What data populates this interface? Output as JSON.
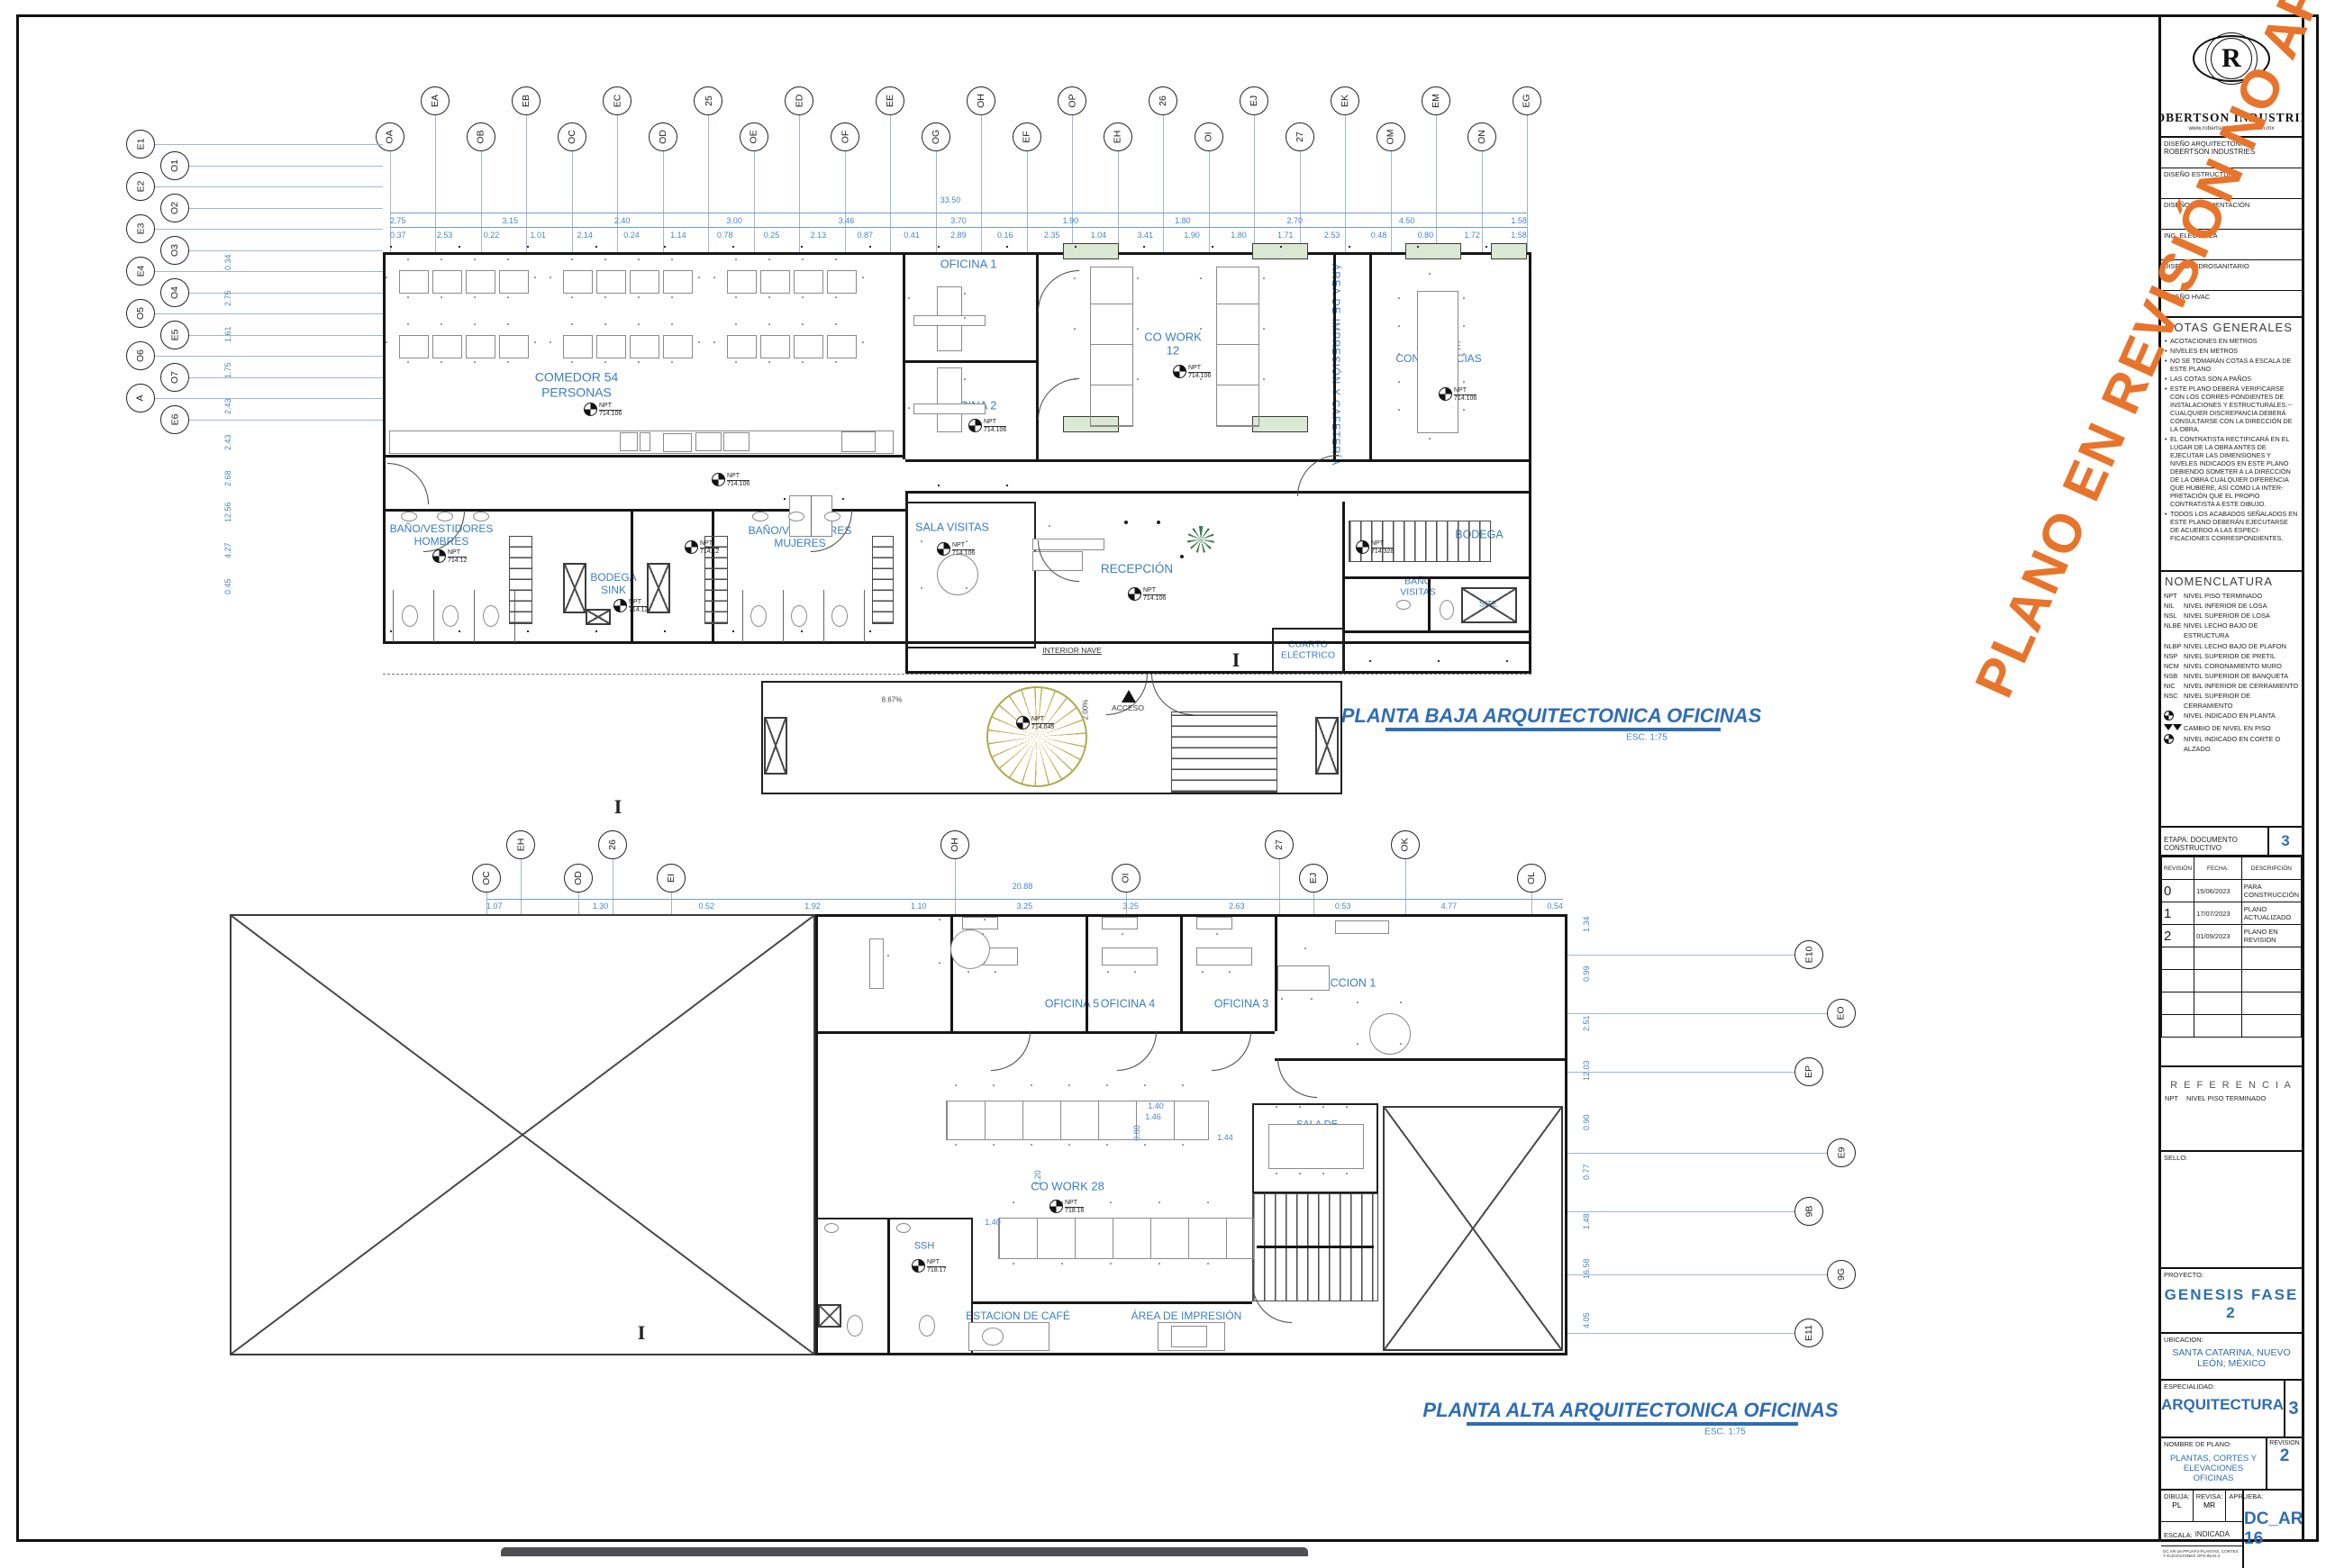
{
  "colors": {
    "accent_blue": "#2f6db5",
    "dim_blue": "#4a85c4",
    "watermark_orange": "#E8742B",
    "window_green": "#dbe8d3",
    "column_blue": "#49648f"
  },
  "watermark": "PLANO EN REVISIÓN NO APROBADO PARA CONSTRUCCIÓN",
  "title_block": {
    "logo_letter": "R",
    "company": "ROBERTSON  INDUSTRIES",
    "website": "www.robertsonindustries.com.mx",
    "design_rows": [
      {
        "label": "DISEÑO  ARQUITECTONICO",
        "value": "ROBERTSON INDUSTRIES"
      },
      {
        "label": "DISEÑO  ESTRUCTURAL",
        "value": ""
      },
      {
        "label": "DISEÑO  DE  CIMENTACIÓN",
        "value": ""
      },
      {
        "label": "ING.  ELÉCTRICA",
        "value": ""
      },
      {
        "label": "DISEÑO  HIDROSANITARIO",
        "value": ""
      },
      {
        "label": "DISEÑO  HVAC",
        "value": ""
      }
    ],
    "notas": {
      "title": "NOTAS GENERALES",
      "items": [
        "ACOTACIONES EN METROS",
        "NIVELES EN METROS",
        "NO SE TOMARÁN COTAS A ESCALA DE ESTE PLANO",
        "LAS COTAS SON A PAÑOS",
        "ESTE PLANO DEBERÁ VERIFICARSE CON LOS CORRES-PONDIENTES DE INSTALACIONES Y ESTRUCTURALES.--CUALQUIER DISCREPANCIA DEBERÁ CONSULTARSE CON LA DIRECCIÓN DE LA OBRA.",
        "EL CONTRATISTA RECTIFICARÁ EN EL LUGAR DE LA OBRA ANTES DE EJECUTAR LAS DIMENSIONES Y NIVELES INDICADOS EN ESTE PLANO DEBIENDO SOMETER A LA DIRECCIÓN DE LA OBRA CUALQUIER DIFERENCIA QUE HUBIERE, ASÍ COMO LA INTER-PRETACIÓN QUE EL PROPIO CONTRATISTA A ESTE DIBUJO.",
        "TODOS LOS ACABADOS SEÑALADOS EN ESTE PLANO DEBERÁN EJECUTARSE DE ACUERDO A LAS ESPECI-FICACIONES CORRESPONDIENTES."
      ]
    },
    "nomenclatura": {
      "title": "NOMENCLATURA",
      "items": [
        {
          "abbr": "NPT",
          "text": "NIVEL PISO TERMINADO",
          "icon": ""
        },
        {
          "abbr": "NIL",
          "text": "NIVEL INFERIOR DE LOSA",
          "icon": ""
        },
        {
          "abbr": "NSL",
          "text": "NIVEL SUPERIOR DE LOSA",
          "icon": ""
        },
        {
          "abbr": "NLBE",
          "text": "NIVEL LECHO BAJO DE ESTRUCTURA",
          "icon": ""
        },
        {
          "abbr": "NLBP",
          "text": "NIVEL LECHO BAJO DE PLAFON",
          "icon": ""
        },
        {
          "abbr": "NSP",
          "text": "NIVEL SUPERIOR DE PRETIL",
          "icon": ""
        },
        {
          "abbr": "NCM",
          "text": "NIVEL CORONAMIENTO MURO",
          "icon": ""
        },
        {
          "abbr": "NSB",
          "text": "NIVEL SUPERIOR DE BANQUETA",
          "icon": ""
        },
        {
          "abbr": "NIC",
          "text": "NIVEL INFERIOR DE CERRAMIENTO",
          "icon": ""
        },
        {
          "abbr": "NSC",
          "text": "NIVEL SUPERIOR DE CERRAMIENTO",
          "icon": ""
        },
        {
          "abbr": "",
          "text": "NIVEL INDICADO EN PLANTA",
          "icon": "level-plan-icon"
        },
        {
          "abbr": "",
          "text": "CAMBIO DE NIVEL EN PISO",
          "icon": "level-change-icon"
        },
        {
          "abbr": "",
          "text": "NIVEL INDICADO EN CORTE O ALZADO",
          "icon": "level-elevation-icon"
        }
      ]
    },
    "etapa": {
      "label": "ETAPA: DOCUMENTO CONSTRUCTIVO",
      "number": "3"
    },
    "revisions": {
      "headers": [
        "REVISIÓN",
        "FECHA:",
        "DESCRIPCIÓN"
      ],
      "rows": [
        [
          "0",
          "15/06/2023",
          "PARA CONSTRUCCIÓN"
        ],
        [
          "1",
          "17/07/2023",
          "PLANO ACTUALIZADO"
        ],
        [
          "2",
          "01/09/2023",
          "PLANO EN REVISION"
        ]
      ]
    },
    "referencia": {
      "title": "R E F E R E N C I A",
      "abbr": "NPT",
      "text": "NIVEL PISO TERMINADO"
    },
    "sello_label": "SELLO:",
    "proyecto": {
      "label": "PROYECTO:",
      "value": "GENESIS FASE 2"
    },
    "ubicacion": {
      "label": "UBICACION:",
      "value": "SANTA CATARINA, NUEVO LEÓN; MÉXICO"
    },
    "especialidad": {
      "label": "ESPECIALIDAD:",
      "value": "ARQUITECTURA",
      "number": "3"
    },
    "nombre_plano": {
      "label": "NOMBRE DE PLANO:",
      "value": "PLANTAS, CORTES Y ELEVACIONES OFICINAS",
      "revision_label": "REVISION",
      "revision": "2"
    },
    "firmas": {
      "dibuja_label": "DIBUJA:",
      "dibuja": "PL",
      "revisa_label": "REVISA:",
      "revisa": "MR",
      "aprueba_label": "APRUEBA:",
      "aprueba": ""
    },
    "escala": {
      "label": "ESCALA:",
      "value": "INDICADA"
    },
    "file_code": "DC AR-16-PPUAF2-PLANTAS, CORTES Y ELEVACIONES OFICINAS-2",
    "sheet_number": "DC_AR-16"
  },
  "planta_baja": {
    "title": "PLANTA BAJA ARQUITECTONICA OFICINAS",
    "scale": "ESC. 1:75",
    "grid_top": [
      "OA",
      "EA",
      "OB",
      "EB",
      "OC",
      "EC",
      "OD",
      "25",
      "OE",
      "ED",
      "OF",
      "EE",
      "OG",
      "OH",
      "EF",
      "OP",
      "EH",
      "26",
      "OI",
      "EJ",
      "27",
      "EK",
      "OM",
      "EM",
      "ON",
      "EG"
    ],
    "grid_left": [
      "E1",
      "O1",
      "E2",
      "O2",
      "E3",
      "O3",
      "E4",
      "O4",
      "O5",
      "E5",
      "O6",
      "O7",
      "A",
      "E6"
    ],
    "dim_total": "33.50",
    "dims_row1": [
      "2.75",
      "3.15",
      "2.40",
      "3.00",
      "3.46",
      "3.70",
      "1.90",
      "1.80",
      "2.70",
      "4.50",
      "1.58"
    ],
    "dims_row2": [
      "0.37",
      "2.53",
      "0.22",
      "1.01",
      "2.14",
      "0.24",
      "1.14",
      "0.78",
      "0.25",
      "2.13",
      "0.87",
      "0.41",
      "2.89",
      "0.16",
      "2.35",
      "1.04",
      "3.41",
      "1.90",
      "1.80",
      "1.71",
      "2.53",
      "0.48",
      "0.80",
      "1.72",
      "1.58"
    ],
    "dims_left": [
      "0.34",
      "2.75",
      "1.61",
      "1.75",
      "2.43",
      "2.43",
      "2.68",
      "12.56",
      "4.27",
      "0.45"
    ],
    "labels": {
      "comedor": "COMEDOR 54\nPERSONAS",
      "oficina1": "OFICINA 1",
      "oficina2": "OFICINA 2",
      "cowork": "CO WORK\n12",
      "impresion_cafeteria": "ÁREA DE IMPRESIÓN Y CAFETERÍA",
      "sala_conf": "SALA DE\nCONFERENCIAS\n(12)",
      "hombres": "BAÑO/VESTIDORES\nHOMBRES",
      "bodega_sink": "BODEGA\nSINK",
      "mujeres": "BAÑO/VESTIDORES\nMUJERES",
      "vending": "VENDING\nMACHINE",
      "sala_visitas": "SALA VISITAS",
      "recepcion": "RECEPCIÓN",
      "bodega": "BODEGA",
      "bano_visitas": "BAÑO\nVISITAS",
      "cuarto_electrico": "CUARTO\nELÉCTRICO",
      "site": "SITE",
      "interior_nave": "INTERIOR NAVE",
      "acceso": "ACCESO",
      "agua": "AGUA",
      "hmicr1": "H.MICR",
      "hmicr2": "H.MICR",
      "pct1": "8.67%",
      "pct2": "2.00%"
    },
    "npt_prefix": "NPT",
    "npt_values": [
      "714.106",
      "714.106",
      "714.106",
      "714.106",
      "714.106",
      "714.106",
      "714.106",
      "714.12",
      "714.12",
      "714.12",
      "714.328",
      "714.045"
    ]
  },
  "planta_alta": {
    "title": "PLANTA ALTA ARQUITECTONICA OFICINAS",
    "scale": "ESC. 1:75",
    "grid_top": [
      "OC",
      "EH",
      "OD",
      "26",
      "EI",
      "OH",
      "OI",
      "27",
      "EJ",
      "OK",
      "OL"
    ],
    "grid_right": [
      "E10",
      "EO",
      "EP",
      "E9",
      "9B",
      "9G",
      "E11"
    ],
    "dim_total": "20.88",
    "dims_row1": [
      "1.07",
      "1.30",
      "0.52",
      "1.92",
      "1.10",
      "3.25",
      "3.25",
      "2.63",
      "0.53",
      "4.77",
      "0.54"
    ],
    "dims_right": [
      "1.34",
      "0.99",
      "2.51",
      "12.03",
      "0.90",
      "0.77",
      "1.48",
      "16.58",
      "4.05"
    ],
    "labels": {
      "oficina5": "OFICINA 5",
      "oficina4": "OFICINA 4",
      "oficina3": "OFICINA 3",
      "direccion1": "DIRECCION 1",
      "sala_conf8": "SALA DE\nCONFERENCIAS\n(8)",
      "cowork28": "CO WORK 28",
      "ssh": "SSH",
      "estacion_cafe": "ESTACION DE CAFÉ",
      "area_impresion": "ÁREA DE IMPRESIÓN",
      "dim_146": "1.46",
      "dim_080": "0.80",
      "dim_144": "1.44",
      "dim_120": "1.20",
      "dim_140a": "1.40",
      "dim_140b": "1.40"
    },
    "npt_values": [
      "718.16",
      "718.17"
    ]
  }
}
